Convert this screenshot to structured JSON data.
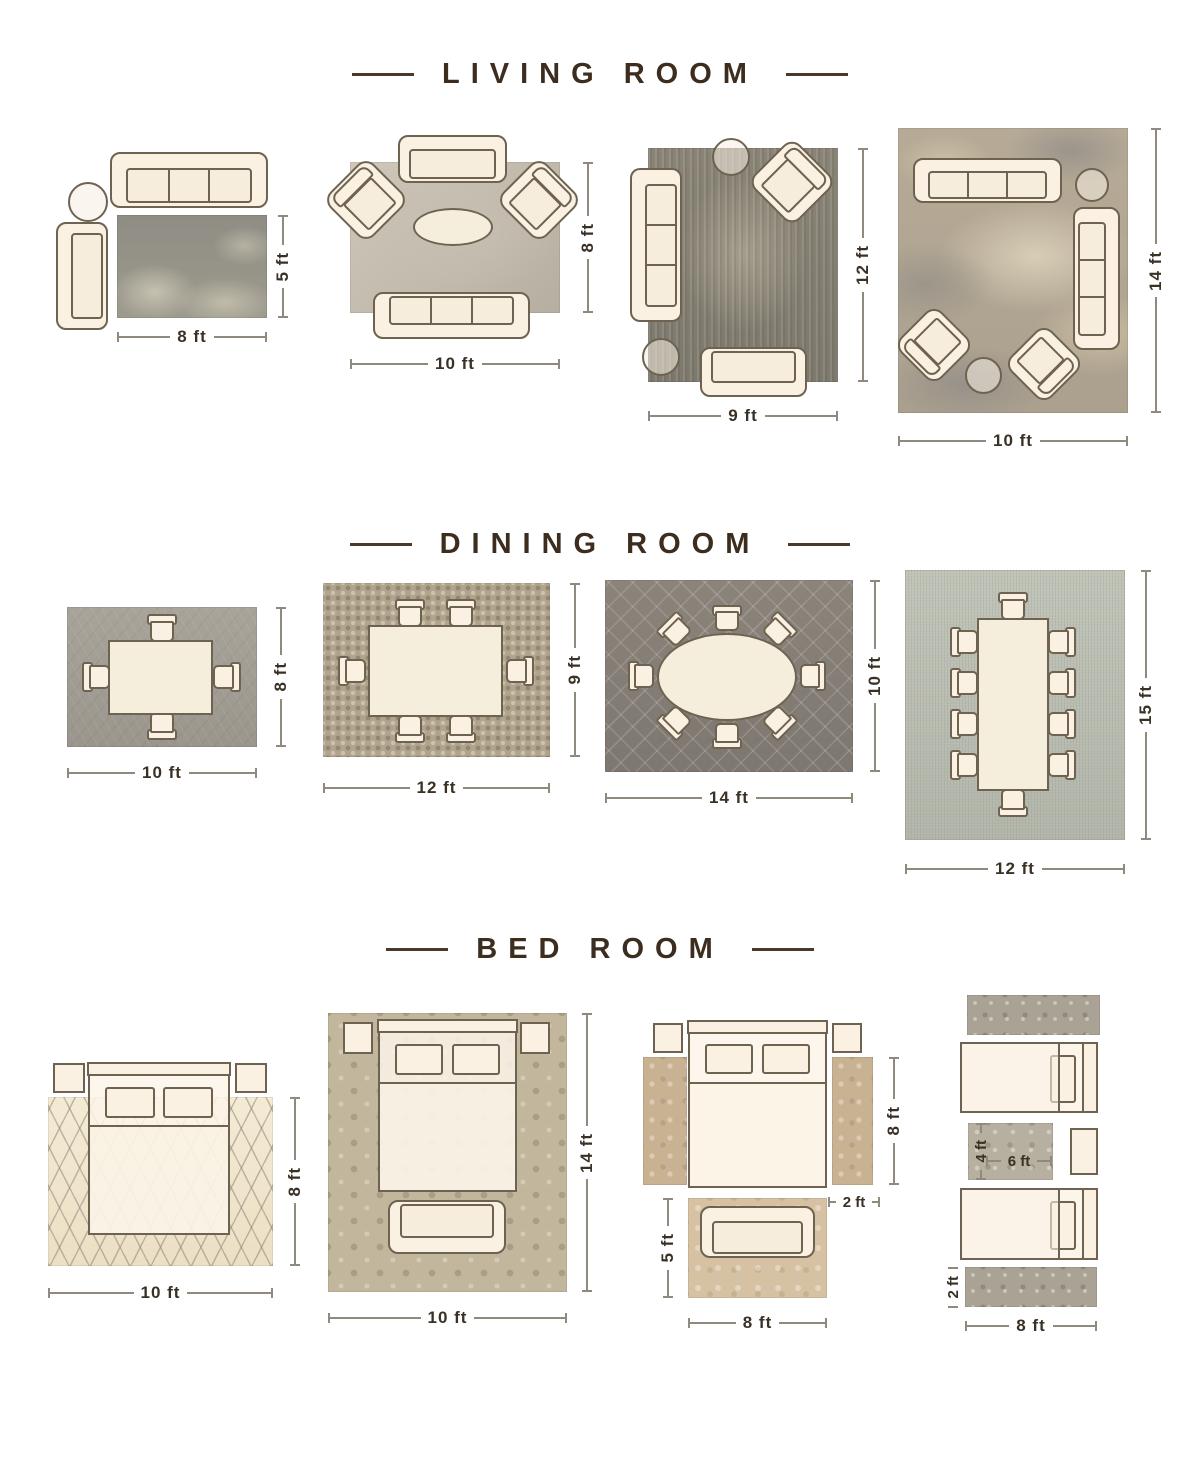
{
  "palette": {
    "title_color": "#3c2d1f",
    "dimension_text_color": "#3a3126",
    "dimension_line_color": "#8f897e",
    "furniture_outline_color": "#6e6350",
    "furniture_fill_color": "#faf1e2",
    "background_color": "#ffffff"
  },
  "sections": [
    {
      "title": "LIVING ROOM",
      "layouts": [
        {
          "name": "sofa-chaise-corner",
          "width_label": "8 ft",
          "height_label": "5 ft",
          "furniture": [
            "3-seat sofa",
            "round side table",
            "chaise sofa",
            "distressed gray rug"
          ]
        },
        {
          "name": "conversation-set",
          "width_label": "10 ft",
          "height_label": "8 ft",
          "furniture": [
            "loveseat",
            "2 angled armchairs",
            "oval coffee table",
            "3-seat sofa",
            "light gray rug"
          ]
        },
        {
          "name": "sofa-loveseat",
          "width_label": "9 ft",
          "height_label": "12 ft",
          "furniture": [
            "round table",
            "angled armchair",
            "3-seat sofa",
            "round ottoman",
            "loveseat",
            "distressed taupe rug"
          ]
        },
        {
          "name": "large-seating-group",
          "width_label": "10 ft",
          "height_label": "14 ft",
          "furniture": [
            "3-seat sofa",
            "round side table",
            "3-seat sofa",
            "2 angled armchairs",
            "round ottoman",
            "abstract beige rug"
          ]
        }
      ]
    },
    {
      "title": "DINING ROOM",
      "layouts": [
        {
          "name": "square-table-4-chairs",
          "width_label": "10 ft",
          "height_label": "8 ft",
          "furniture": [
            "square dining table",
            "4 chairs",
            "gray rug"
          ]
        },
        {
          "name": "rect-table-6-chairs",
          "width_label": "12 ft",
          "height_label": "9 ft",
          "furniture": [
            "rectangular dining table",
            "6 chairs",
            "mosaic rug"
          ]
        },
        {
          "name": "oval-table-8-chairs",
          "width_label": "14 ft",
          "height_label": "10 ft",
          "furniture": [
            "oval dining table",
            "8 chairs",
            "dark trellis rug"
          ]
        },
        {
          "name": "long-table-10-chairs",
          "width_label": "12 ft",
          "height_label": "15 ft",
          "furniture": [
            "long dining table",
            "10 chairs",
            "light gray rug"
          ]
        }
      ]
    },
    {
      "title": "BED ROOM",
      "layouts": [
        {
          "name": "bed-on-rug-lower-two-thirds",
          "width_label": "10 ft",
          "height_label": "8 ft",
          "furniture": [
            "queen bed",
            "2 nightstands",
            "cream diamond rug"
          ]
        },
        {
          "name": "all-furniture-on-rug",
          "width_label": "10 ft",
          "height_label": "14 ft",
          "furniture": [
            "queen bed",
            "2 nightstands",
            "foot bench",
            "damask rug"
          ]
        },
        {
          "name": "runners-plus-foot-rug",
          "side_runner_height_label": "8 ft",
          "side_runner_width_label": "2 ft",
          "foot_rug_height_label": "5 ft",
          "foot_rug_width_label": "8 ft",
          "furniture": [
            "queen bed",
            "2 nightstands",
            "2 side runners",
            "foot sofa",
            "tan floral rug"
          ]
        },
        {
          "name": "twin-beds-runners",
          "accent_rug_height_label": "4 ft",
          "accent_rug_width_label": "6 ft",
          "runner_height_label": "2 ft",
          "runner_width_label": "8 ft",
          "furniture": [
            "2 twin beds",
            "nightstand",
            "2 ornate runners",
            "center accent rug"
          ]
        }
      ]
    }
  ]
}
